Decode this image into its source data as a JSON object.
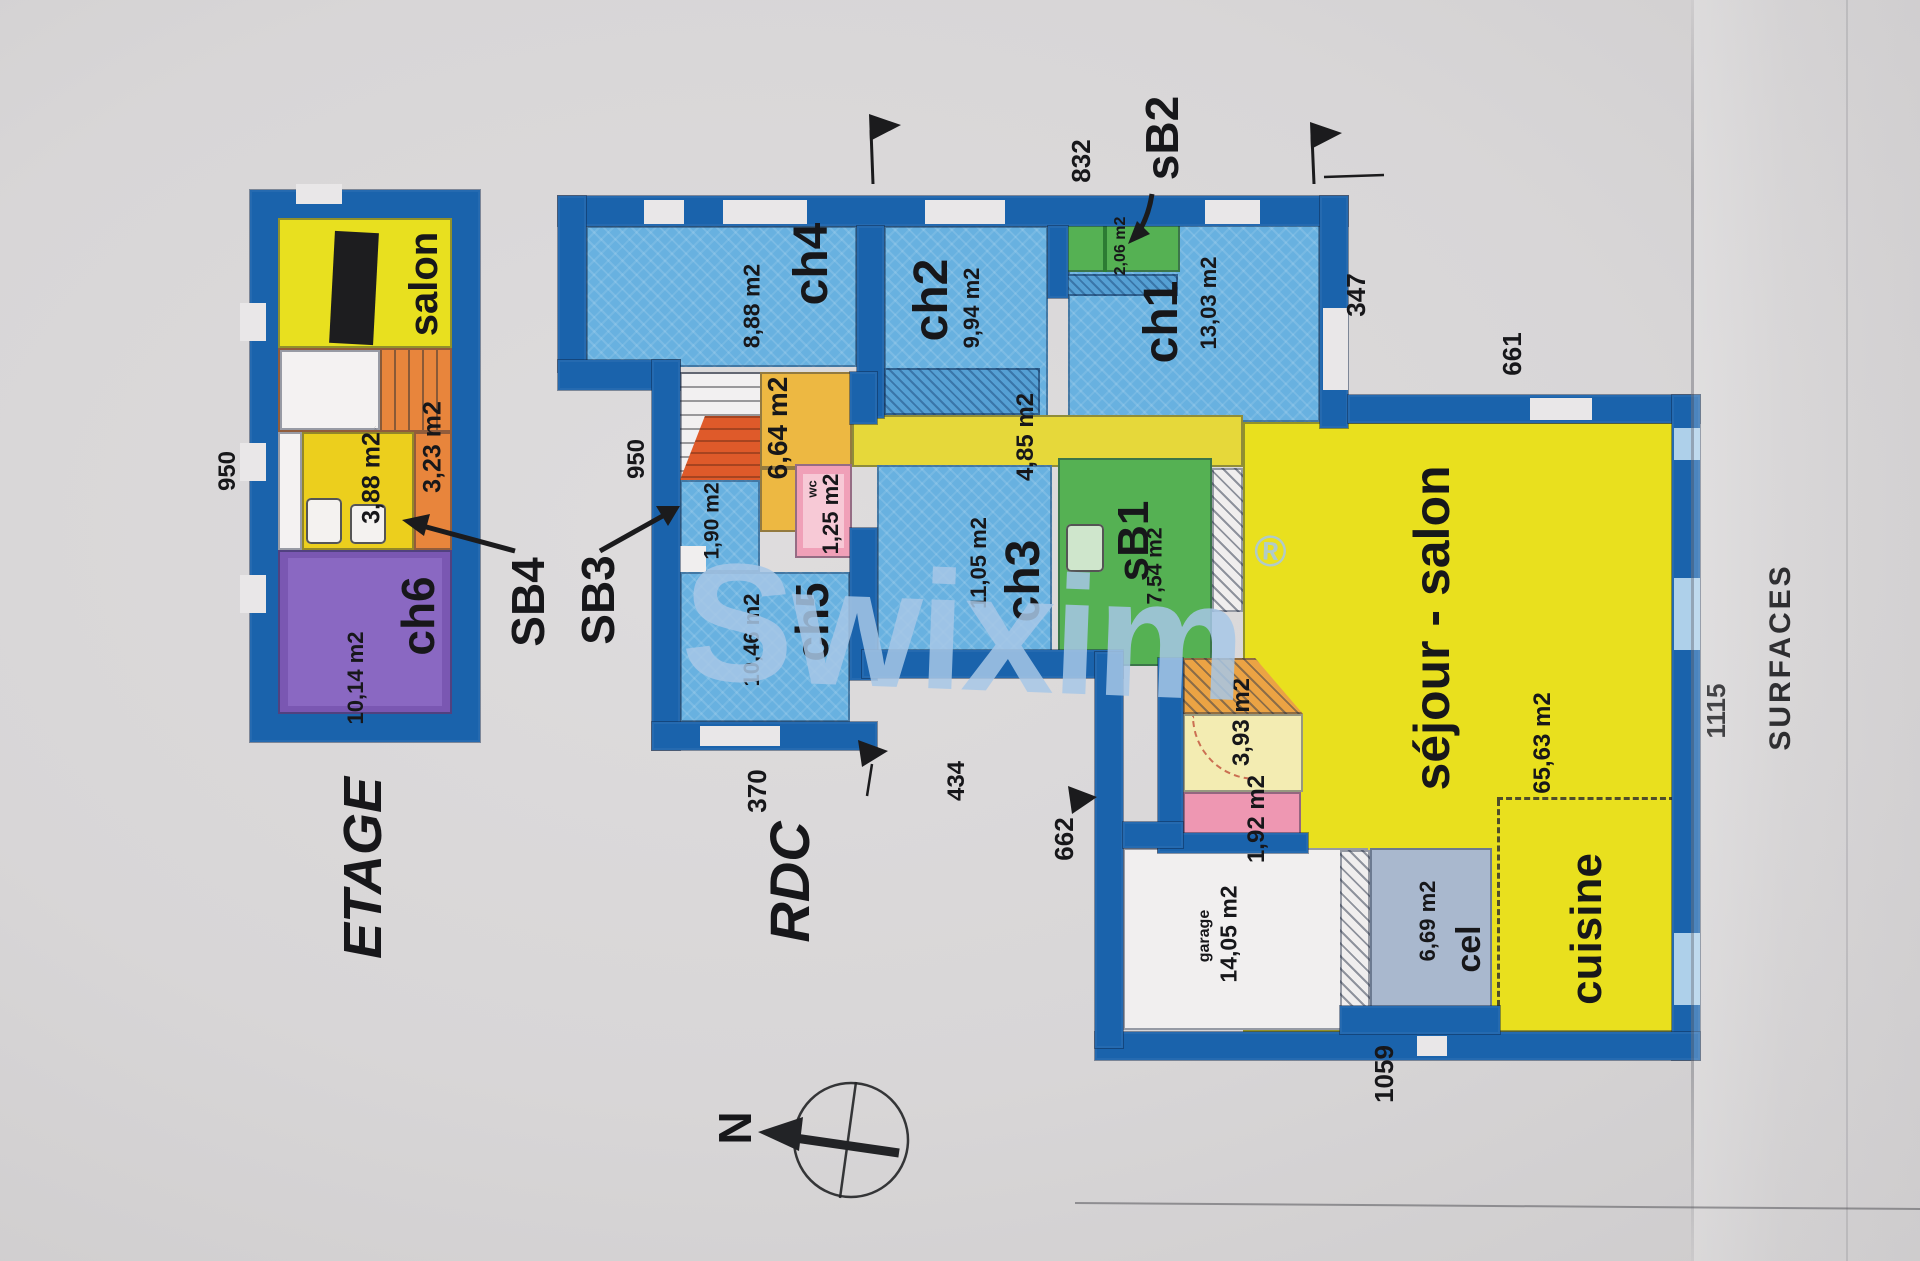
{
  "watermark": {
    "brand": "Swixim",
    "registered_mark": "®"
  },
  "etage": {
    "title": "ETAGE",
    "dim_left": "950",
    "salon": "salon",
    "palier_area": "3,23 m2",
    "sdb_area": "3,88 m2",
    "ch6": "ch6",
    "ch6_area": "10,14 m2"
  },
  "rdc": {
    "title": "RDC",
    "ch4": "ch4",
    "ch4_area": "8,88 m2",
    "ch2": "ch2",
    "ch2_area": "9,94 m2",
    "sb2_area": "2,06 m2",
    "ch1": "ch1",
    "ch1_area": "13,03 m2",
    "hall_area": "4,85 m2",
    "degagement_area": "6,64 m2",
    "rangement_area": "1,90 m2",
    "wc": "wc",
    "wc_area": "1,25 m2",
    "ch5": "ch5",
    "ch5_area": "10,46 m2",
    "ch3": "ch3",
    "ch3_area": "11,05 m2",
    "sb1": "sB1",
    "sb1_area": "7,54 m2",
    "sejour": "séjour - salon",
    "sejour_area": "65,63 m2",
    "entree_area": "3,93 m2",
    "degagement2_area": "1,92 m2",
    "garage": "garage",
    "garage_area": "14,05 m2",
    "cel": "cel",
    "cel_area": "6,69 m2",
    "cuisine": "cuisine",
    "dims": {
      "d950": "950",
      "d370": "370",
      "d434": "434",
      "d662": "662",
      "d832": "832",
      "d347": "347",
      "d661": "661",
      "d1059": "1059",
      "d1115": "1115"
    }
  },
  "annotations": {
    "sb4": "SB4",
    "sb3": "SB3",
    "sb2": "sB2"
  },
  "surfaces_panel": {
    "title": "SURFACES"
  },
  "compass": {
    "north": "N"
  }
}
